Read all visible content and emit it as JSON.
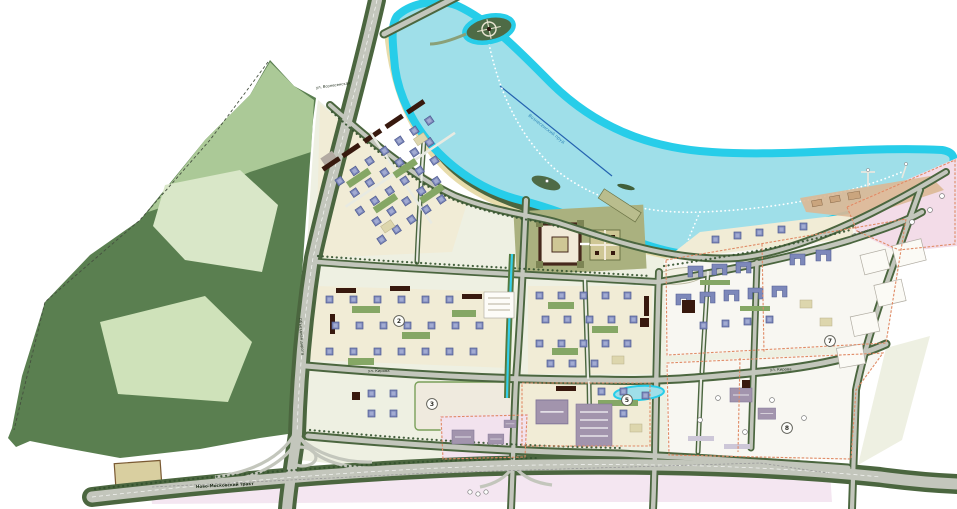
{
  "map": {
    "kind": "urban master plan",
    "badges": [
      {
        "n": "2"
      },
      {
        "n": "3"
      },
      {
        "n": "5"
      },
      {
        "n": "7"
      },
      {
        "n": "8"
      }
    ],
    "labels": {
      "street_voznesenskaya": "ул. Вознесенская",
      "lake_name": "Вознесенский пруд",
      "bypass_road": "Объездная дорога",
      "highway": "Ново-Московский тракт",
      "street_kirova": "ул. Кирова",
      "street_bryusova": "ул. Брюсова"
    },
    "colors": {
      "water_edge": "#27cde9",
      "water_fill": "#9fdfe9",
      "park_dark": "#5a7f50",
      "park_light": "#abc997",
      "park_pale": "#d9e7c8",
      "park_mid": "#cfe2ba",
      "ground": "#eef0e2",
      "block_cream": "#f1ecd6",
      "block_white": "#f8f7f2",
      "pink_zone": "#f2e2ee",
      "pink_zone2": "#f3dce8",
      "verge": "#4b663f",
      "road_fill": "#c3c6bc",
      "road_light": "#e8eae2",
      "tree": "#33512e",
      "maroon": "#38190e",
      "blue_bldg": "#7d88ba",
      "beige_bldg": "#ddd6ad",
      "purple_bldg": "#a294ad",
      "court_green": "#85a765",
      "orange_line": "#e08a65",
      "beach": "#e7dcab",
      "beach2": "#dbb895",
      "canal": "#35cfe8",
      "rowing_line": "#2563b0"
    }
  }
}
